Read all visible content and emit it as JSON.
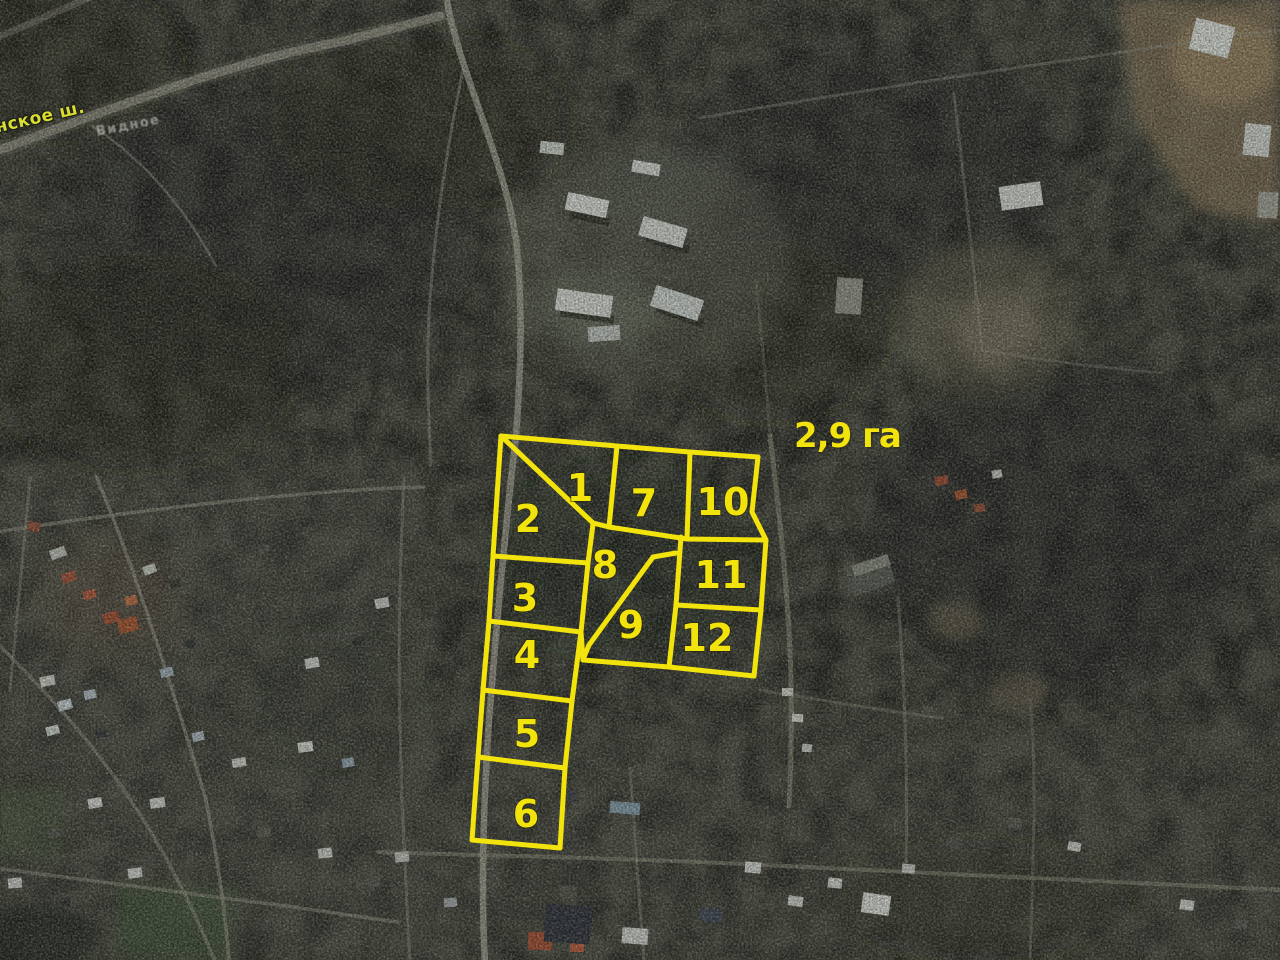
{
  "map": {
    "area_label": "2,9 га",
    "road_label": "нское ш.",
    "place_label": "Видное",
    "colors": {
      "plot_outline": "#f2e30d",
      "plot_label": "#f2e30d",
      "road_label_color": "#d9de35"
    },
    "plots": [
      {
        "number": "1",
        "cx": 580,
        "cy": 487
      },
      {
        "number": "2",
        "cx": 528,
        "cy": 518
      },
      {
        "number": "3",
        "cx": 525,
        "cy": 597
      },
      {
        "number": "4",
        "cx": 527,
        "cy": 654
      },
      {
        "number": "5",
        "cx": 527,
        "cy": 733
      },
      {
        "number": "6",
        "cx": 526,
        "cy": 813
      },
      {
        "number": "7",
        "cx": 644,
        "cy": 502
      },
      {
        "number": "8",
        "cx": 605,
        "cy": 564
      },
      {
        "number": "9",
        "cx": 631,
        "cy": 624
      },
      {
        "number": "10",
        "cx": 723,
        "cy": 501
      },
      {
        "number": "11",
        "cx": 721,
        "cy": 574
      },
      {
        "number": "12",
        "cx": 707,
        "cy": 637
      }
    ],
    "outline_paths": [
      [
        [
          501,
          436
        ],
        [
          617,
          446
        ],
        [
          690,
          452
        ],
        [
          758,
          457
        ]
      ],
      [
        [
          758,
          457
        ],
        [
          752,
          512
        ],
        [
          766,
          540
        ],
        [
          761,
          610
        ],
        [
          754,
          676
        ]
      ],
      [
        [
          754,
          676
        ],
        [
          669,
          667
        ],
        [
          583,
          660
        ]
      ],
      [
        [
          583,
          660
        ],
        [
          581,
          632
        ],
        [
          588,
          563
        ],
        [
          593,
          524
        ]
      ],
      [
        [
          501,
          436
        ],
        [
          593,
          523
        ],
        [
          609,
          527
        ]
      ],
      [
        [
          617,
          446
        ],
        [
          609,
          527
        ]
      ],
      [
        [
          609,
          527
        ],
        [
          687,
          539
        ],
        [
          766,
          540
        ]
      ],
      [
        [
          690,
          452
        ],
        [
          687,
          539
        ]
      ],
      [
        [
          681,
          537
        ],
        [
          676,
          605
        ]
      ],
      [
        [
          676,
          605
        ],
        [
          761,
          610
        ]
      ],
      [
        [
          676,
          605
        ],
        [
          669,
          667
        ]
      ],
      [
        [
          653,
          557
        ],
        [
          589,
          645
        ],
        [
          584,
          657
        ]
      ],
      [
        [
          653,
          557
        ],
        [
          676,
          553
        ]
      ],
      [
        [
          501,
          436
        ],
        [
          493,
          556
        ],
        [
          489,
          621
        ],
        [
          483,
          690
        ],
        [
          478,
          757
        ],
        [
          472,
          840
        ]
      ],
      [
        [
          493,
          556
        ],
        [
          588,
          563
        ]
      ],
      [
        [
          489,
          621
        ],
        [
          581,
          632
        ]
      ],
      [
        [
          581,
          632
        ],
        [
          572,
          701
        ],
        [
          565,
          768
        ],
        [
          560,
          848
        ]
      ],
      [
        [
          483,
          690
        ],
        [
          572,
          701
        ]
      ],
      [
        [
          478,
          757
        ],
        [
          565,
          768
        ]
      ],
      [
        [
          472,
          840
        ],
        [
          560,
          848
        ]
      ]
    ]
  }
}
